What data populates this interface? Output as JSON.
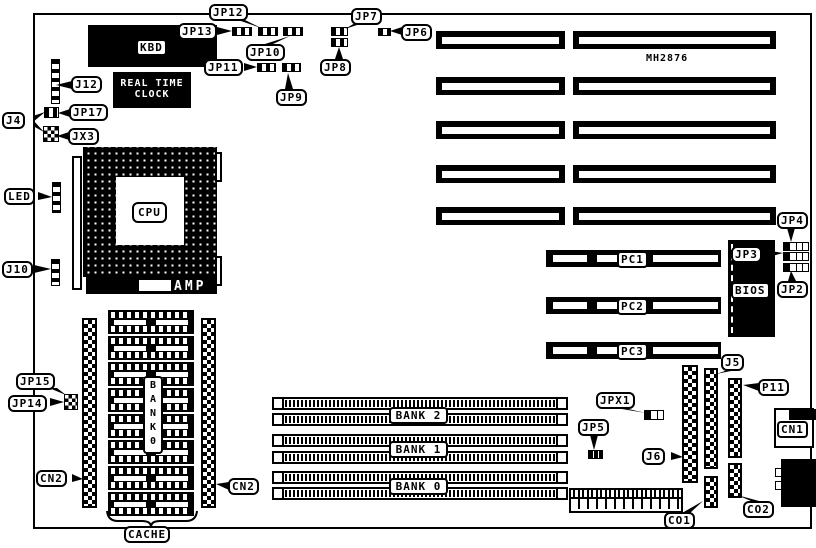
{
  "diagram": {
    "type": "motherboard-layout",
    "colors": {
      "foreground": "#000000",
      "background": "#ffffff"
    },
    "model_text": "MH2876",
    "labels": {
      "kbd": "KBD",
      "rtc_line1": "REAL TIME",
      "rtc_line2": "CLOCK",
      "j12": "J12",
      "jp17": "JP17",
      "jx3": "JX3",
      "j4": "J4",
      "led": "LED",
      "j10": "J10",
      "cpu": "CPU",
      "amp": "AMP",
      "jp13": "JP13",
      "jp12": "JP12",
      "jp10": "JP10",
      "jp11": "JP11",
      "jp9": "JP9",
      "jp7": "JP7",
      "jp8": "JP8",
      "jp6": "JP6",
      "jp4": "JP4",
      "jp3": "JP3",
      "jp2": "JP2",
      "bios": "BIOS",
      "pc1": "PC1",
      "pc2": "PC2",
      "pc3": "PC3",
      "jp15": "JP15",
      "jp14": "JP14",
      "cn2_left": "CN2",
      "cn2_right": "CN2",
      "cache": "CACHE",
      "cache_bank_vertical": "B\nA\nN\nK\n0",
      "bank2": "BANK 2",
      "bank1": "BANK 1",
      "bank0": "BANK 0",
      "jpx1": "JPX1",
      "jp5": "JP5",
      "j6": "J6",
      "j5": "J5",
      "p11": "P11",
      "cn1": "CN1",
      "co1": "CO1",
      "co2": "CO2"
    }
  }
}
